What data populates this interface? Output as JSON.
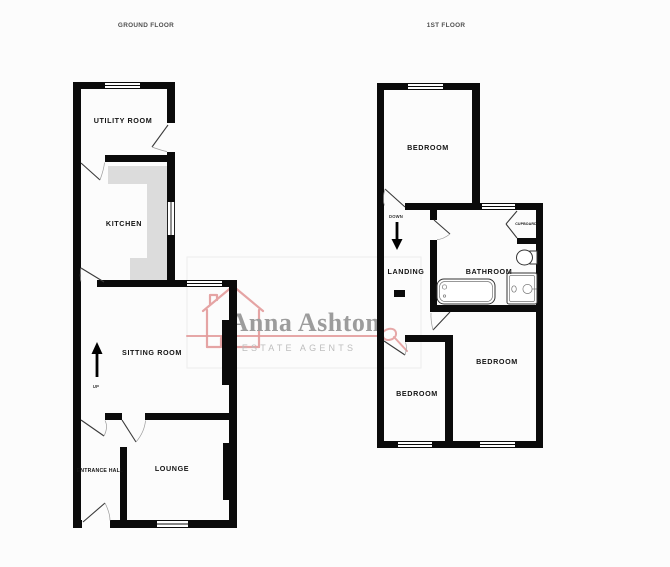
{
  "titles": {
    "ground_floor": "GROUND FLOOR",
    "first_floor": "1ST FLOOR"
  },
  "ground_floor": {
    "rooms": {
      "utility_room": "UTILITY ROOM",
      "kitchen": "KITCHEN",
      "sitting_room": "SITTING ROOM",
      "entrance_hall": "ENTRANCE HALL",
      "lounge": "LOUNGE",
      "stairs_direction": "UP"
    }
  },
  "first_floor": {
    "rooms": {
      "bedroom_top": "BEDROOM",
      "landing": "LANDING",
      "bathroom": "BATHROOM",
      "cupboard": "CUPBOARD",
      "bedroom_bottom_left": "BEDROOM",
      "bedroom_bottom_right": "BEDROOM",
      "stairs_direction": "DOWN"
    }
  },
  "watermark": {
    "name": "Anna Ashton",
    "tagline": "ESTATE AGENTS"
  },
  "colors": {
    "background": "#fcfcfc",
    "wall": "#0b0b0b",
    "counter": "#dcdcdc",
    "label": "#141414",
    "title_gray": "#4f4f4f",
    "door_stroke": "#3a3a3a",
    "stair_stroke": "#555555",
    "brand_pink": "#e39b9b",
    "brand_name_gray": "#9c9c9c",
    "brand_tagline_gray": "#bdbdbd",
    "watermark_box": "#ededed"
  }
}
